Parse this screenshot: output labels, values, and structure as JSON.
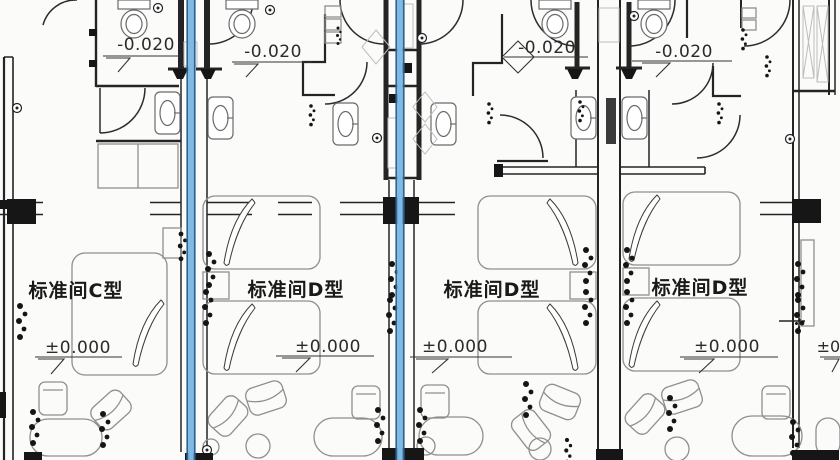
{
  "drawing": {
    "type": "architectural floor plan — hotel standard guest rooms",
    "room_labels": [
      {
        "text": "标准间C型"
      },
      {
        "text": "标准间D型"
      },
      {
        "text": "标准间D型"
      },
      {
        "text": "标准间D型"
      }
    ],
    "floor_elevations": [
      {
        "text": "±0.000"
      },
      {
        "text": "±0.000"
      },
      {
        "text": "±0.000"
      },
      {
        "text": "±0.000"
      }
    ],
    "bathroom_elevations": [
      {
        "text": "-0.020"
      },
      {
        "text": "-0.020"
      },
      {
        "text": "-0.020"
      },
      {
        "text": "-0.020"
      }
    ],
    "partial_elevation_right": {
      "text": "±0.0"
    },
    "colors": {
      "wall": "#242424",
      "furniture_line": "#8f8f8f",
      "highlight_fill": "#7fbae5",
      "highlight_edge": "#2b6492",
      "background": "#fbfbfa",
      "text": "#1f1f1f"
    }
  }
}
